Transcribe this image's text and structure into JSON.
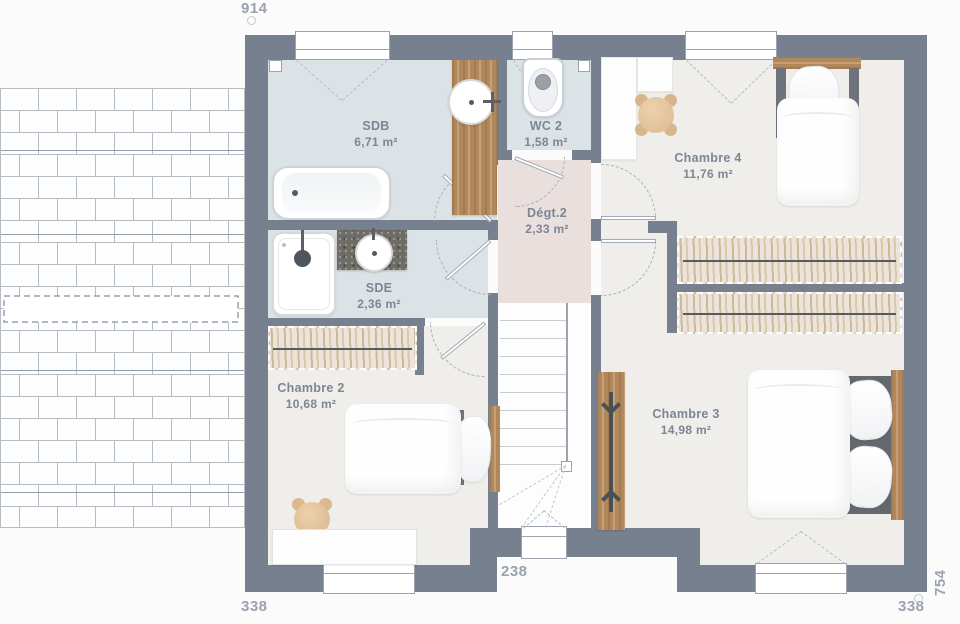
{
  "title": "Plan d'étage",
  "dimensions": {
    "top": "914",
    "bottom_left": "338",
    "bottom_center": "238",
    "bottom_right": "338",
    "right": "754"
  },
  "rooms": [
    {
      "name": "SDB",
      "area": "6,71 m²"
    },
    {
      "name": "WC 2",
      "area": "1,58 m²"
    },
    {
      "name": "Chambre 4",
      "area": "11,76 m²"
    },
    {
      "name": "Dégt.2",
      "area": "2,33 m²"
    },
    {
      "name": "SDE",
      "area": "2,36 m²"
    },
    {
      "name": "Chambre 2",
      "area": "10,68 m²"
    },
    {
      "name": "Chambre 3",
      "area": "14,98 m²"
    }
  ],
  "furniture": [
    "bathtub",
    "vanity-sink",
    "toilet",
    "shower",
    "stone-counter-sink",
    "single-bed",
    "single-bed",
    "double-bed",
    "wardrobe",
    "wardrobe",
    "wardrobe",
    "desk",
    "ladder-rack",
    "pouf",
    "teddy-bear",
    "staircase"
  ],
  "colors": {
    "wall": "#76808F",
    "bath_floor": "#DCE3E6",
    "hall_floor": "#E9DFDD",
    "bedroom_floor": "#F0EEEA",
    "wood": "#B1885C",
    "label_text": "#7C8694",
    "dimension_text": "#99A2AE"
  }
}
